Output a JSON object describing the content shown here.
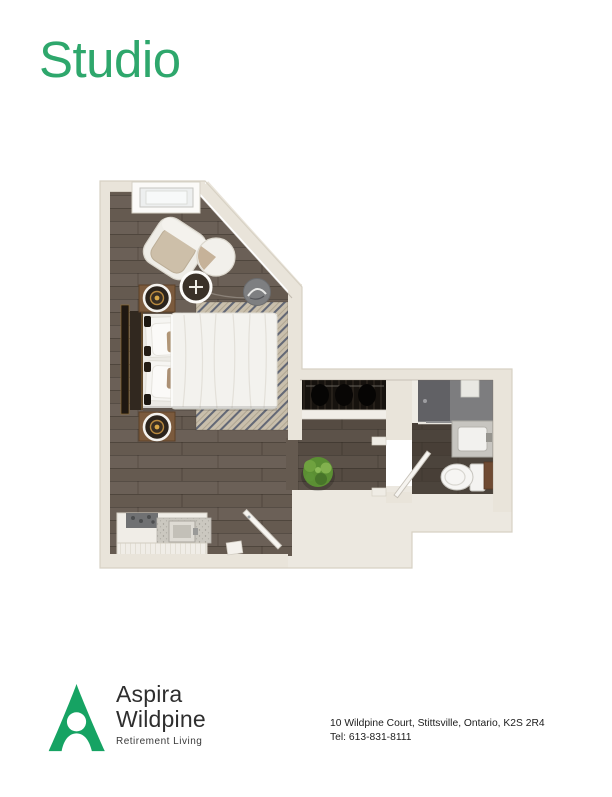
{
  "title": "Studio",
  "colors": {
    "accent": "#2ea76c",
    "logo-green": "#16a363",
    "wall": "#e9e4da",
    "wall-edge": "#d7d1c4",
    "mass": "#ece8e0",
    "floor": "#655a50",
    "floor-dark": "#483f37",
    "rug": "#c9bfac",
    "rug-stripe": "#33405c",
    "closet": "#16120e",
    "shower-gray": "#616165"
  },
  "logo": {
    "line1": "Aspira",
    "line2": "Wildpine",
    "tagline": "Retirement Living"
  },
  "contact": {
    "address": "10 Wildpine Court, Stittsville, Ontario, K2S 2R4",
    "phone": "Tel: 613-831-8111"
  },
  "floor_plan": {
    "name": "studio-suite-floor-plan",
    "rooms": [
      "bedroom-living",
      "closet",
      "bathroom",
      "kitchenette",
      "entry"
    ],
    "furniture": [
      "window",
      "armchair",
      "side-table",
      "arc-lamp-table",
      "pouf",
      "bed",
      "nightstand-lamps",
      "area-rug",
      "wall-art",
      "plant",
      "kitchenette-counter",
      "closet-hangers",
      "shower",
      "vanity-sink",
      "toilet",
      "entry-door",
      "bathroom-door"
    ]
  }
}
